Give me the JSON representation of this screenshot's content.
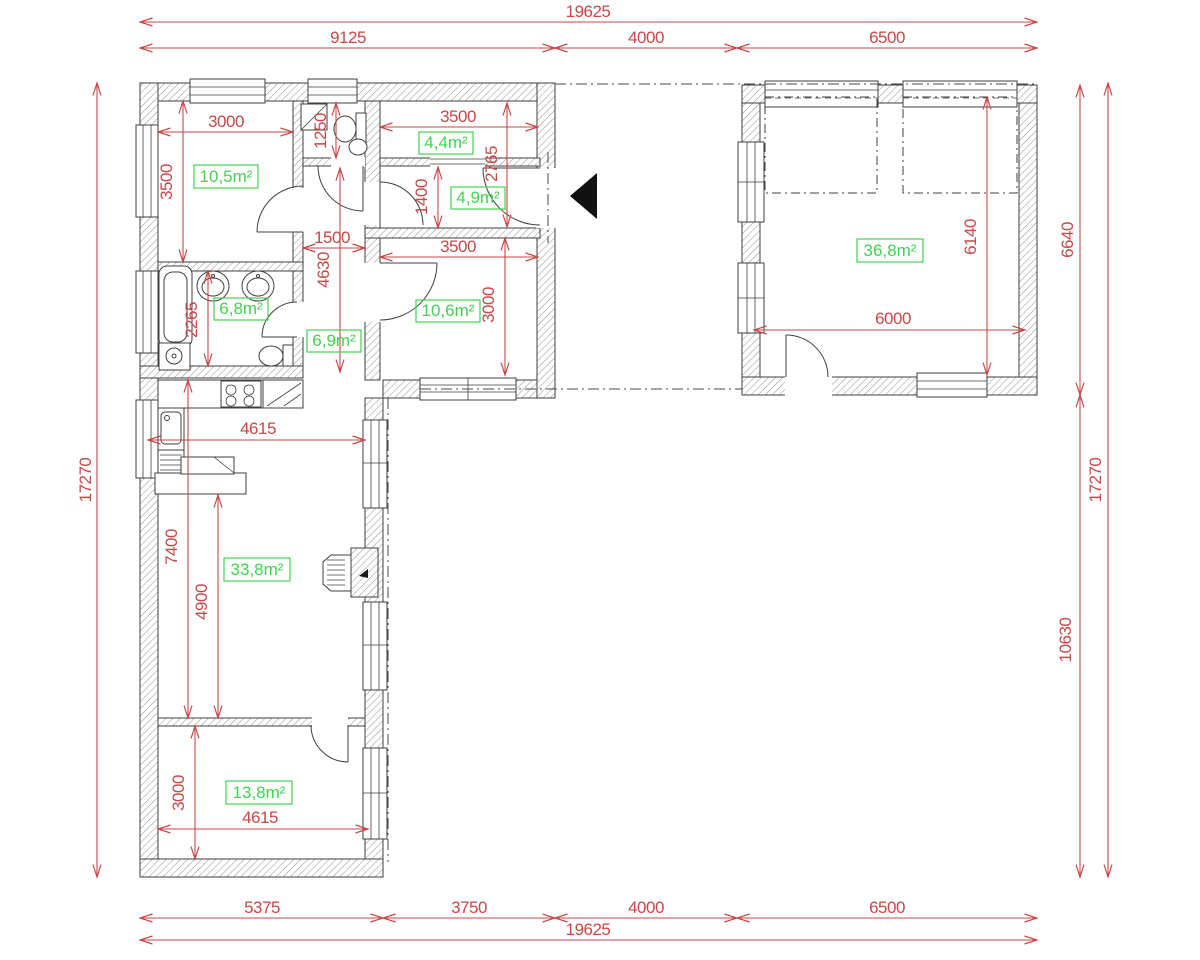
{
  "title": "L-shaped house floor plan with garage",
  "colors": {
    "dimension_red": "#c94747",
    "area_green": "#3fd44f",
    "wall_outline": "#3f3f3f",
    "hatch_gray": "#9a9a9a"
  },
  "icons": {
    "entrance": "entrance-arrow"
  },
  "dims": {
    "overall_top": "19625",
    "top_seg1": "9125",
    "top_seg2": "4000",
    "top_seg3": "6500",
    "bottom_seg1": "5375",
    "bottom_seg2": "3750",
    "bottom_seg3": "4000",
    "bottom_seg4": "6500",
    "overall_bottom": "19625",
    "left_total": "17270",
    "right_total": "17270",
    "right_upper": "6640",
    "right_lower": "10630",
    "bed1_width": "3000",
    "bed1_depth": "3500",
    "wc_depth": "1250",
    "storage_width": "3500",
    "storage_entry_depth": "2765",
    "entry_depth": "1400",
    "hall_width": "1500",
    "hall_length": "4630",
    "bed2_width": "3500",
    "bed2_depth": "3000",
    "bath_depth": "2265",
    "kitchen_width": "4615",
    "living_len1": "7400",
    "living_len2": "4900",
    "bed3_depth": "3000",
    "bed3_width": "4615",
    "garage_depth": "6140",
    "garage_width": "6000"
  },
  "areas": {
    "bed1": "10,5m²",
    "storage": "4,4m²",
    "entry": "4,9m²",
    "bed2": "10,6m²",
    "bath": "6,8m²",
    "hall": "6,9m²",
    "garage": "36,8m²",
    "living": "33,8m²",
    "bed3": "13,8m²"
  }
}
